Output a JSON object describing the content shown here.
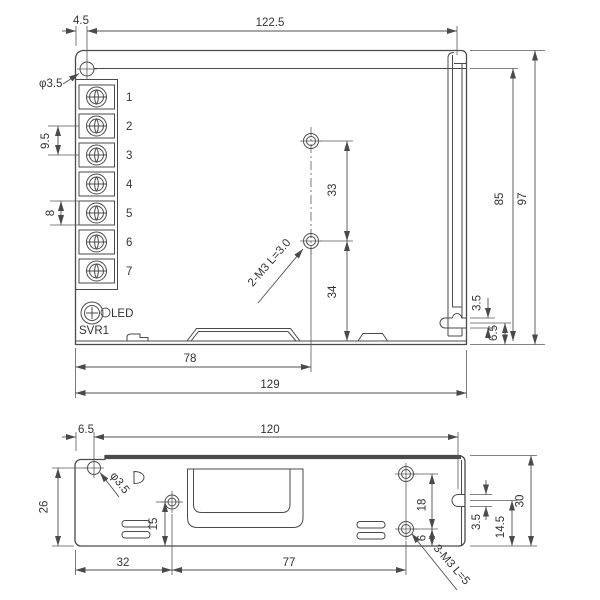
{
  "drawing": {
    "colors": {
      "line": "#4a4a4a",
      "text": "#333333",
      "background": "#ffffff"
    },
    "views": {
      "top": {
        "dims": {
          "d4_5": "4.5",
          "d122_5": "122.5",
          "phi3_5": "φ3.5",
          "d9_5": "9.5",
          "d8": "8",
          "d33": "33",
          "d34": "34",
          "m3_note": "2-M3 L=3.0",
          "d85": "85",
          "d97": "97",
          "d3_5": "3.5",
          "d6_5": "6.5",
          "d78": "78",
          "d129": "129"
        },
        "terminals": [
          "1",
          "2",
          "3",
          "4",
          "5",
          "6",
          "7"
        ],
        "led_label": "LED",
        "svr_label": "SVR1"
      },
      "bottom": {
        "dims": {
          "d6_5": "6.5",
          "d120": "120",
          "phi3_5": "φ3.5",
          "d26": "26",
          "d15": "15",
          "d32": "32",
          "d77": "77",
          "d18": "18",
          "d6": "6",
          "d3_5": "3.5",
          "d14_5": "14.5",
          "d30": "30",
          "m3_note": "3-M3 L=5"
        }
      }
    }
  }
}
